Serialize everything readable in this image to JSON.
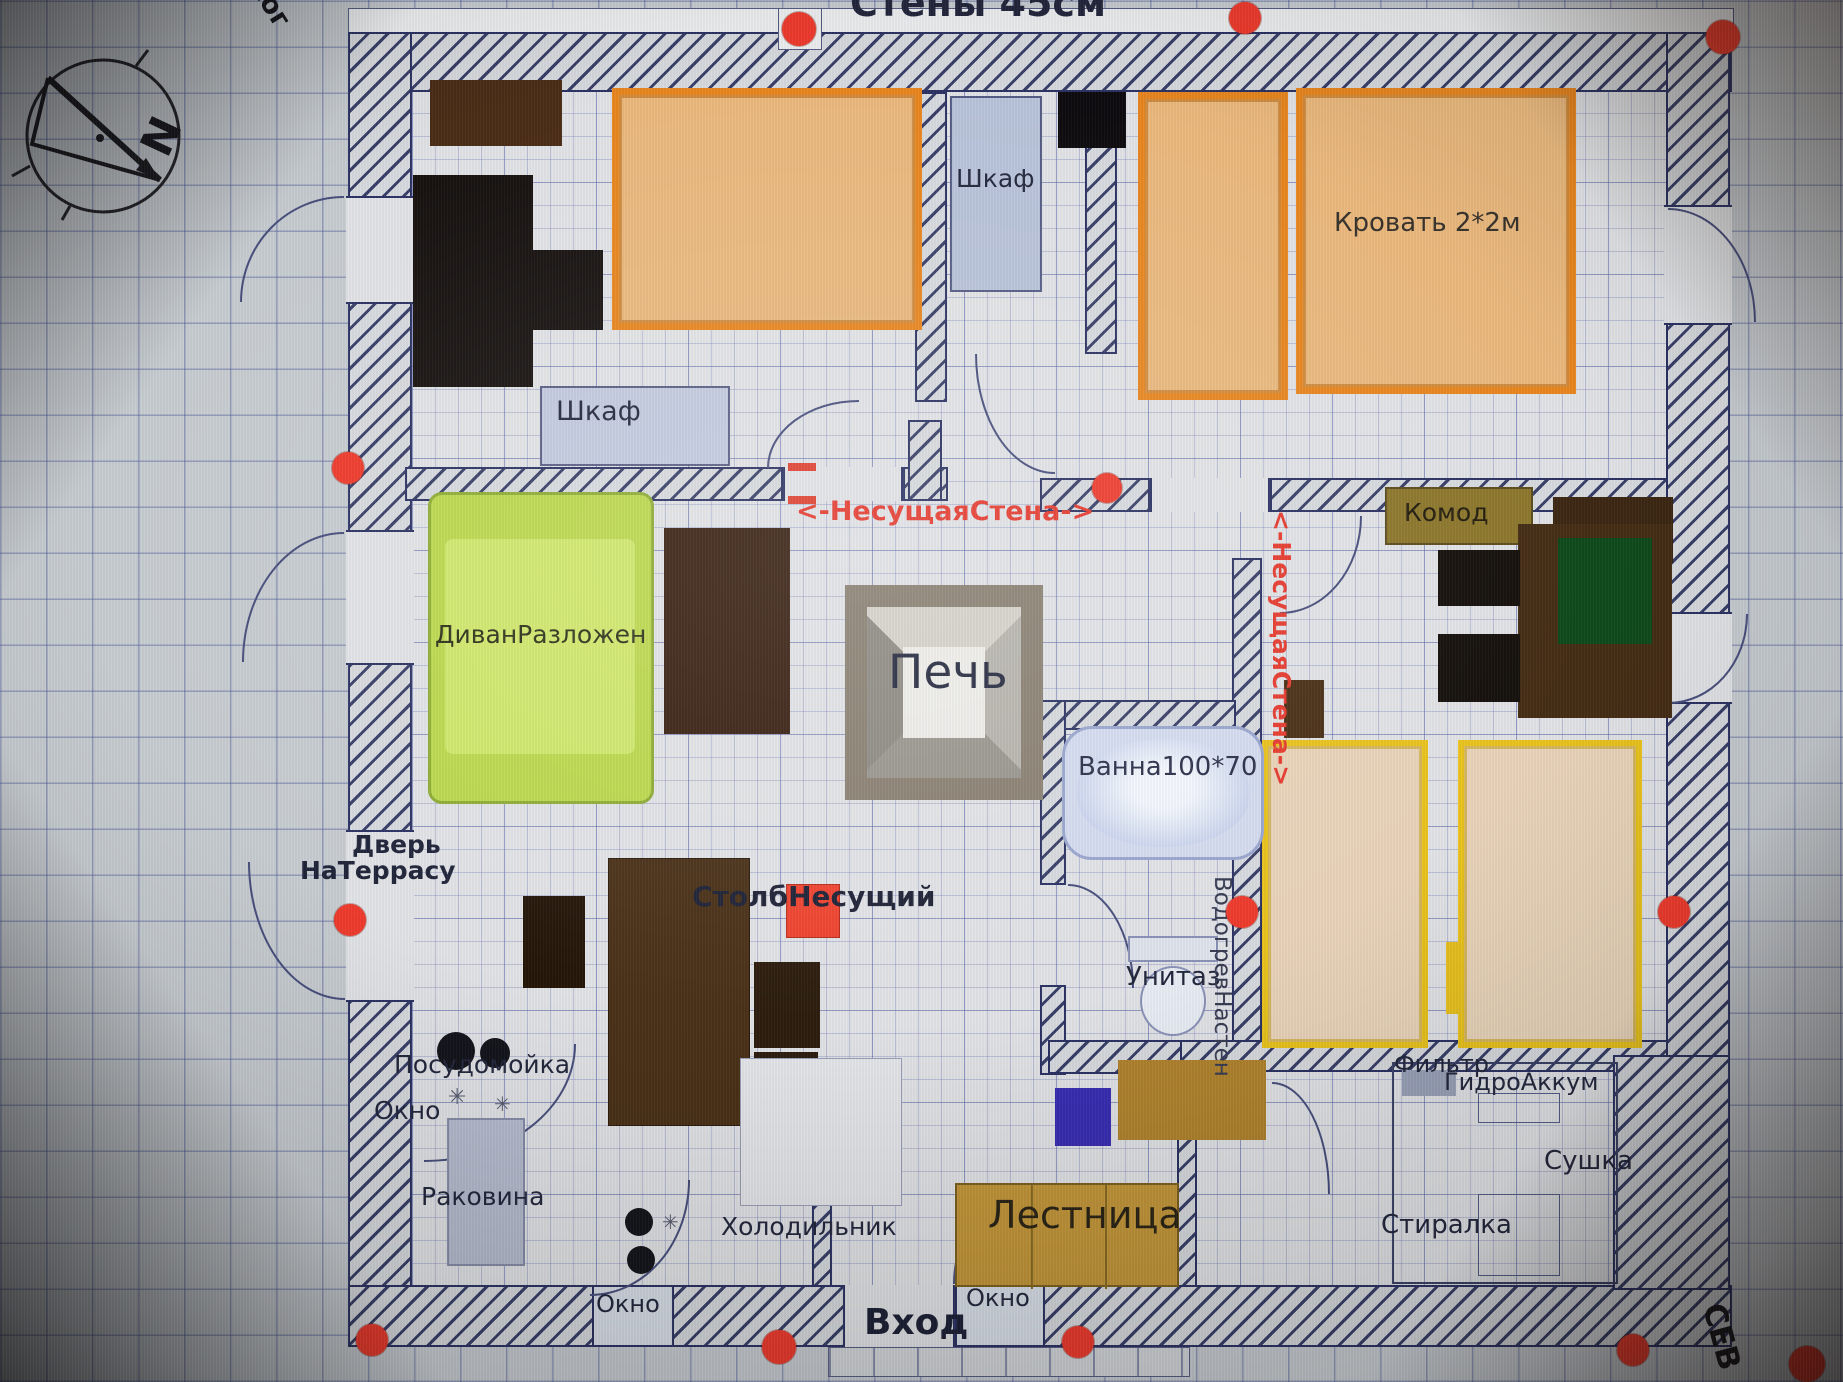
{
  "title": {
    "top_wall": "Стены 45см"
  },
  "compass": {
    "north_letter": "N",
    "south_label": "юг",
    "north_edge_label": "СЕВ"
  },
  "structure": {
    "load_bearing_wall": "<-НесущаяСтена->",
    "pillar": "СтолбНесущий",
    "terrace_door_line1": "Дверь",
    "terrace_door_line2": "НаТеррасу",
    "entrance": "Вход",
    "window": "Окно",
    "stairs": "Лестница"
  },
  "furniture": {
    "wardrobe": "Шкаф",
    "bed_2x2": "Кровать 2*2м",
    "dresser": "Комод",
    "sofa_unfolded": "ДиванРазложен",
    "stove": "Печь",
    "bath_100x70": "Ванна100*70",
    "dishwasher": "Посудомойка",
    "sink": "Раковина",
    "fridge": "Холодильник",
    "toilet": "Унитаз",
    "water_heater_wall": "ВодогревНастен",
    "filter": "Фильтр",
    "hydro_accumulator": "ГидроАккум",
    "dryer": "Сушка",
    "washer": "Стиралка"
  },
  "decor": {
    "sparkle": "✳"
  },
  "colors": {
    "marker_red": "#ee3b2d",
    "load_bearing_text_red": "#e63a2e",
    "bed_border_orange": "#e8861f",
    "bed_fill_tan": "#eab97e",
    "bed_border_yellow": "#e9c31d",
    "sofa_green": "#c3e055",
    "stair_tan": "#c3963a",
    "dresser_olive": "#8d772c",
    "dark_wood": "#3a2414",
    "wall_hatch_blue": "#2b3263",
    "paper_gray": "#c7ccd1"
  }
}
